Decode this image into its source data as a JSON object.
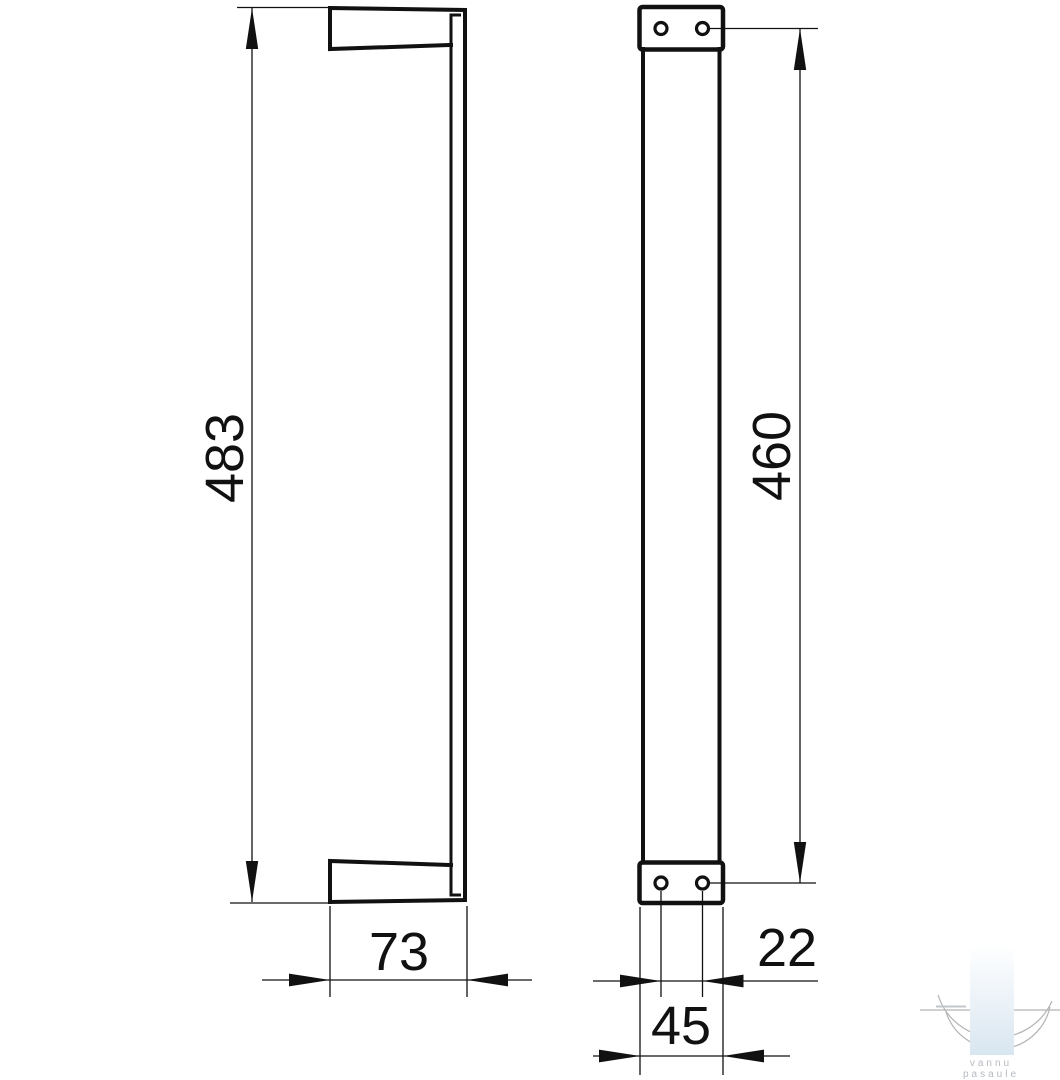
{
  "drawing": {
    "subject": "wall-mounted bar dimensional drawing",
    "line_color": "#111111",
    "background_color": "#ffffff",
    "dimensions": {
      "height": "483",
      "depth": "73",
      "hole_span": "460",
      "hole_pitch": "22",
      "plate_width": "45"
    }
  },
  "watermark": {
    "line1": "vannu",
    "line2": "pasaule",
    "text_color": "#b4bac1",
    "accent_color": "#d8e6f0",
    "arc_color": "#b3b3b3"
  }
}
